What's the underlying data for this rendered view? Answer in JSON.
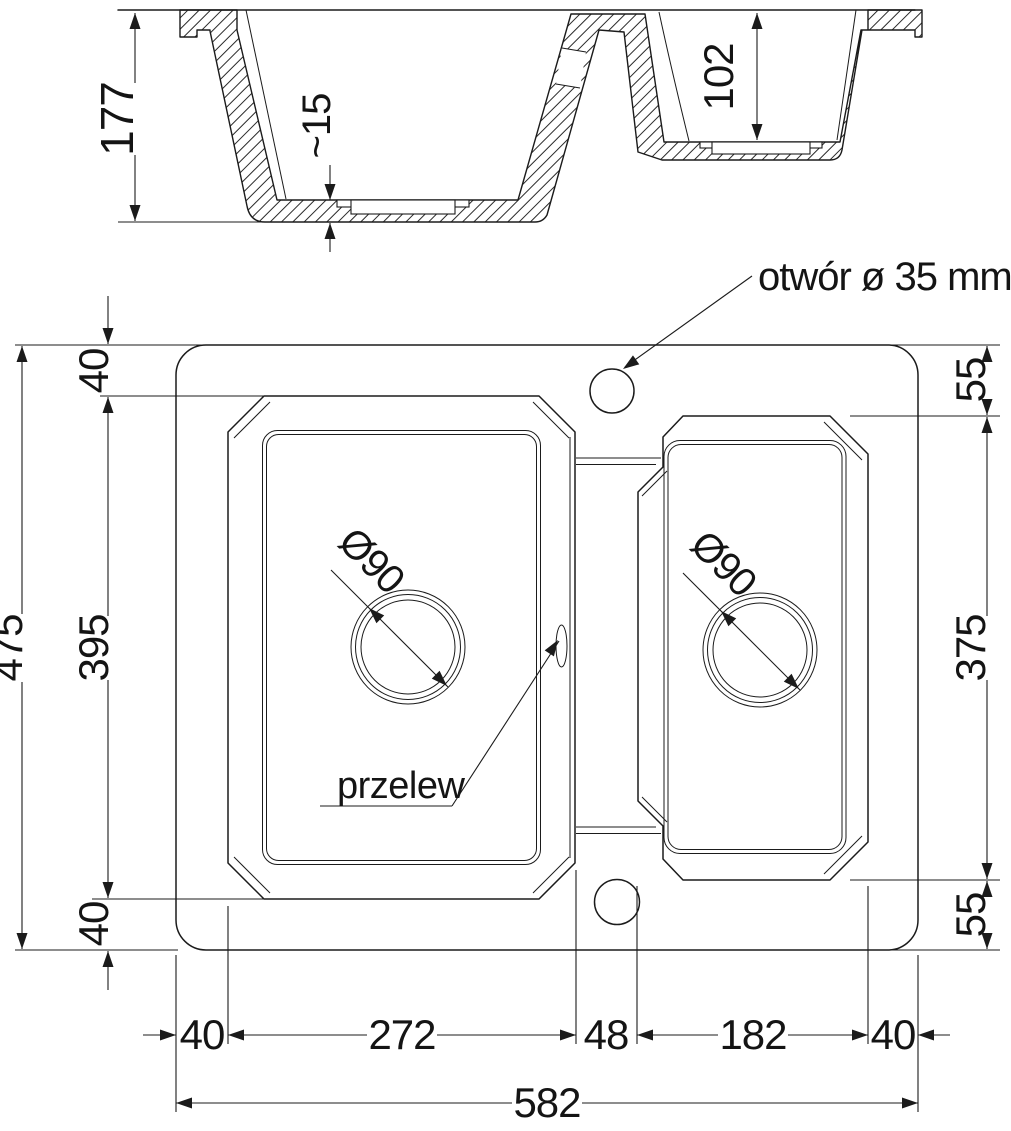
{
  "drawing_title": "kitchen sink technical drawing",
  "colors": {
    "line": "#1b1b1b",
    "background": "#ffffff"
  },
  "section": {
    "depth_main": "177",
    "floor_thickness": "~15",
    "depth_small": "102"
  },
  "plan": {
    "faucet_label": "otwór ø 35 mm",
    "overflow_label": "przelew",
    "drain_left": "Ø90",
    "drain_right": "Ø90",
    "overall_height": "475",
    "bowl_height": "395",
    "margin_top": "40",
    "margin_bottom": "40",
    "right_top": "55",
    "right_bowl_height": "375",
    "right_bottom": "55",
    "chain": [
      "40",
      "272",
      "48",
      "182",
      "40"
    ],
    "overall_width": "582"
  }
}
